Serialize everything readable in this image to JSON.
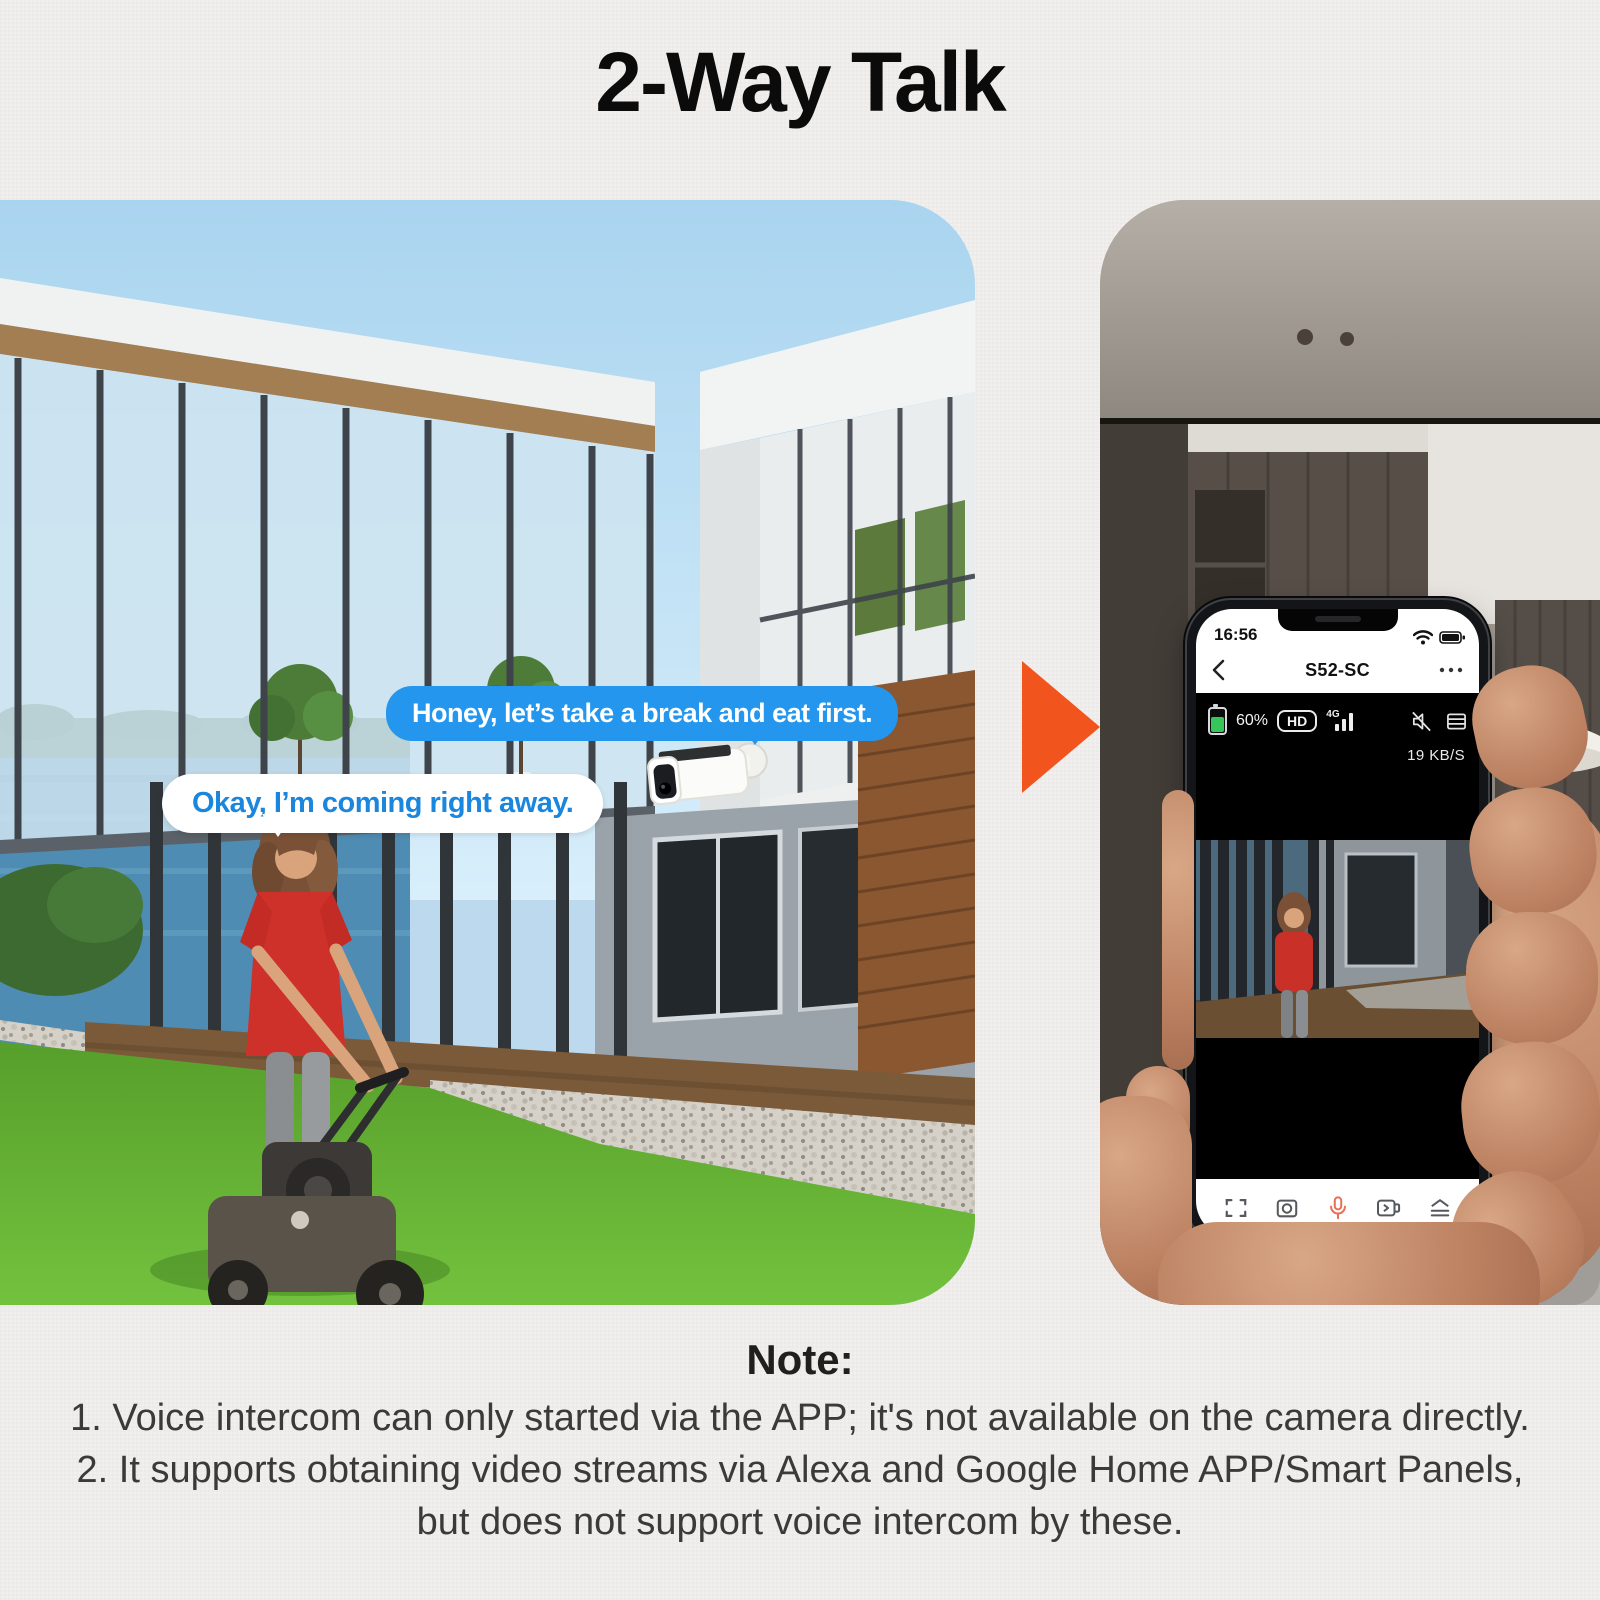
{
  "title": "2-Way Talk",
  "left_scene": {
    "camera_bubble": "Honey, let’s take a break and eat first.",
    "person_bubble": "Okay, I’m coming right away."
  },
  "arrow": {
    "direction": "right",
    "color": "#f2541d"
  },
  "phone": {
    "status_bar": {
      "time": "16:56"
    },
    "nav_bar": {
      "title": "S52-SC"
    },
    "live_view": {
      "battery_percent": "60%",
      "quality_badge": "HD",
      "network_label": "4G",
      "bitrate": "19 KB/S"
    },
    "control_icons": [
      "fullscreen-icon",
      "snapshot-icon",
      "talk-mic-icon",
      "record-icon",
      "menu-icon"
    ],
    "status_icons": [
      "wifi-icon",
      "battery-icon"
    ],
    "live_icons": [
      "battery-level-icon",
      "hd-badge",
      "signal-4g-icon",
      "speaker-muted-icon",
      "stream-list-icon"
    ]
  },
  "note": {
    "heading": "Note:",
    "lines": [
      "1. Voice intercom can only started via the APP; it's not available on the camera directly.",
      "2. It supports obtaining video streams via Alexa and Google Home APP/Smart Panels,",
      "but does not support voice intercom by these."
    ]
  },
  "colors": {
    "background": "#f1f0ee",
    "bubble_blue": "#2496ee",
    "bubble_text_blue": "#1a86dd",
    "arrow_orange": "#f2541d",
    "mic_orange": "#e57258",
    "battery_green": "#35c759"
  }
}
